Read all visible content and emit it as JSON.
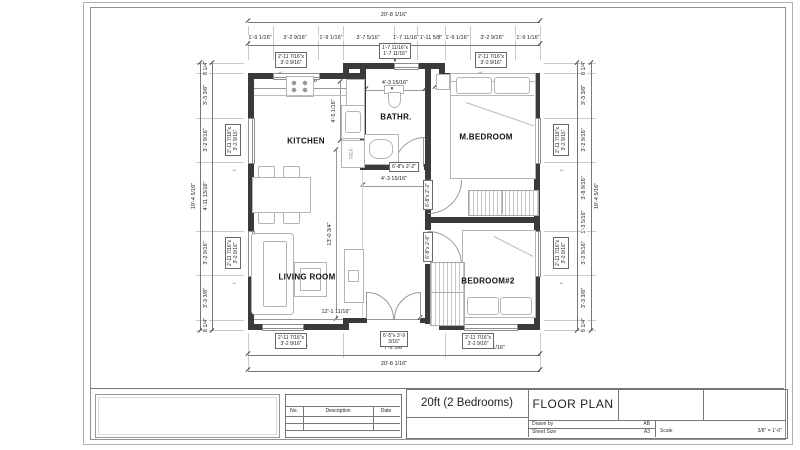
{
  "titleblock": {
    "model_title": "20ft (2 Bedrooms)",
    "drawing_title": "FLOOR PLAN",
    "drawn_by_label": "Drawn by",
    "drawn_by_value": "AB",
    "sheet_size_label": "Sheet Size",
    "sheet_size_value": "A3",
    "scale_label": "Scale",
    "scale_value": "3/8\" = 1'-0\"",
    "revision": {
      "no": "No.",
      "description": "Description",
      "date": "Date"
    }
  },
  "rooms": {
    "kitchen": "KITCHEN",
    "bath": "BATHR.",
    "mbed": "M.BEDROOM",
    "living": "LIVING ROOM",
    "bed2": "BEDROOM#2",
    "fridge": "REF."
  },
  "dims": {
    "top_overall": "20'-8 1/16\"",
    "top": [
      "1'-9 1/16\"",
      "3'-2 9/16\"",
      "1'-9 1/16\"",
      "3'-7 5/16\"",
      "1'-7 11/16\"",
      "1'-11 5/8\"",
      "1'-9 1/16\"",
      "3'-2 9/16\"",
      "1'-9 1/16\""
    ],
    "bottom": [
      "6'-8 11/16\"",
      "7'-2 5/8\"",
      "6'-8 11/16\""
    ],
    "bottom_overall": "20'-8 1/16\"",
    "left_overall": "19'-4 5/16\"",
    "left": [
      "8 1/4\"",
      "3'-3 3/8\"",
      "3'-2 9/16\"",
      "4'-11 13/16\"",
      "3'-2 9/16\"",
      "3'-3 3/8\"",
      "8 1/4\""
    ],
    "right_overall": "19'-4 5/16\"",
    "right": [
      "8 1/4\"",
      "3'-3 3/8\"",
      "3'-2 9/16\"",
      "3'-8 9/16\"",
      "1'-3 5/16\"",
      "3'-2 9/16\"",
      "3'-3 3/8\"",
      "8 1/4\""
    ],
    "kitchen_width": "8'-0 11/16\"",
    "bath_width": "4'-3 15/16\"",
    "mbed_width": "8'-3 3/8\"",
    "kitchen_nook_height": "4'-5 1/16\"",
    "hall_width": "4'-3 15/16\"",
    "living_height": "13'-0 3/4\"",
    "living_width": "12'-1 11/16\""
  },
  "labels": {
    "window_l1": "2'-11 7/16\"x",
    "window_l2": "3'-2 9/16\"",
    "bath_window_l1": "1'-7 11/16\"x",
    "bath_window_l2": "1'-7 11/16\"",
    "door_bath": "6'-8\"x 2'-2\"",
    "door_mbed": "6'-8\"x 2'-2\"",
    "door_bed2": "6'-8\"x 2'-6\"",
    "entry_l1": "6'-5\"x 3'-9",
    "entry_l2": "3/16\""
  },
  "icons": {
    "arrow_right": "→",
    "arrow_left": "←",
    "marker_down": "▼"
  }
}
